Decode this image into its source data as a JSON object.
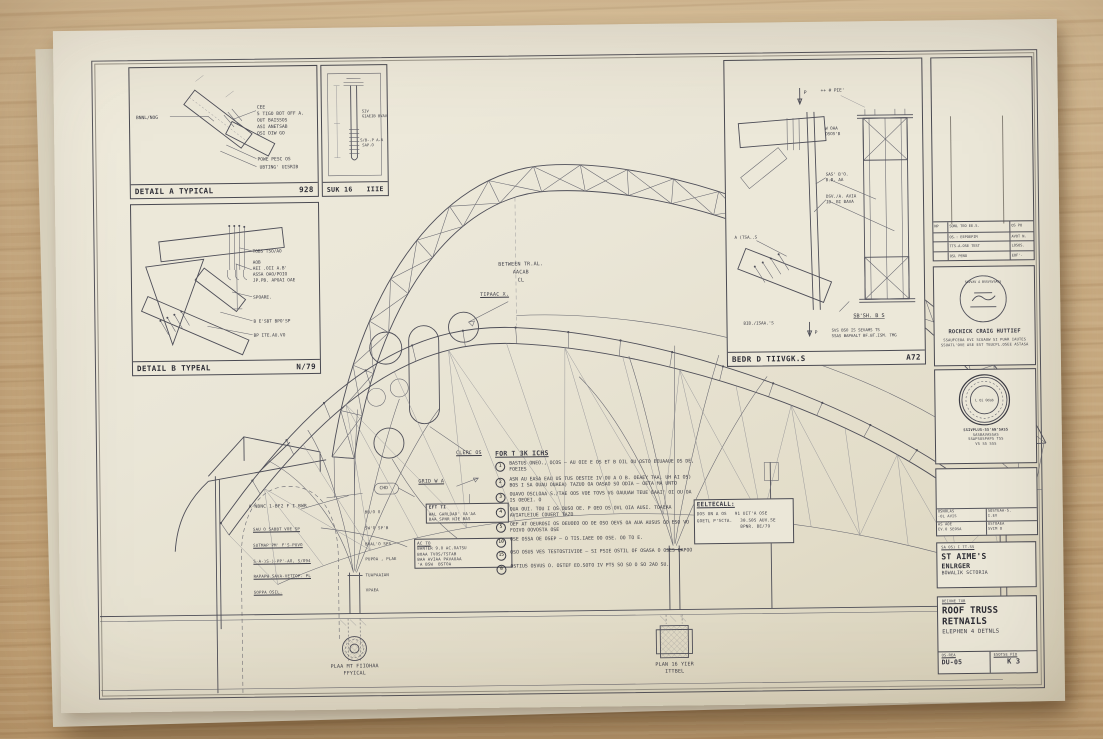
{
  "drawing": {
    "detail_a": {
      "title": "DETAIL A  TYPICAL",
      "ref": "928",
      "left_label": "BNNL/NOG",
      "right_lines": [
        "CEE",
        "5 TIGO BOT OFF A.",
        "OUT  BAISSOS",
        "ASI ANETSAB",
        "OSI DIW GO"
      ],
      "b1": "POWE PESC OS",
      "b2": "UBTING' UISRIB"
    },
    "section_s": {
      "title": "SUK 16",
      "ref": "IIIE",
      "l1": "SIV",
      "l1b": "GIAEIB BVAVA",
      "l2": "S/B-.P  A-A",
      "l2b": "SAP.O"
    },
    "detail_b": {
      "title": "DETAIL B  TYPEAL",
      "ref": "N/79",
      "r1": "TOBS TSO/AO",
      "r2": [
        "AOB",
        "AEI .OII A.B'",
        "ASSA OAO/POIO",
        "JP.PB. APOAI OAE"
      ],
      "r3": "SPOARE.",
      "r4": "B E'SBT BPO'SP",
      "r5": "BP ITE.AU.VO"
    },
    "detail_d": {
      "title": "BEDR D TIIVGK.S",
      "ref": "A72",
      "a1": "++ # PIE'",
      "a2": "W OAA",
      "a2b": "OSOS'B",
      "a3": "SAS' B'O.",
      "a3b": "B.B. AA",
      "a4": "DSV./A. AVIA",
      "a4b": "IB. BI BAVA",
      "a5": "A (TSA..S",
      "a6": "BIB./ISAA.'S",
      "sec": "SB'SH. B S",
      "note1": "SVS BSO IS SEVAMS TS",
      "note2": "SSAS BAPAALT BF.BT.ISM. TMG",
      "p_top": "P",
      "p_bot": "P"
    },
    "main": {
      "t1": "BETWEEN TR.AL.",
      "t2": "AACAB",
      "t3": "CL",
      "typical": "TIPAAC X.",
      "grid": "GRID W A",
      "cleric": "CLERC OS",
      "chd": "CHD",
      "ln1": "A-NBNC 1-BF2 F I BWR",
      "ln2": [
        "SAU O SABBT VOE SP",
        "SUTMAP'PM' F'S-PUVO",
        "S-A-)S-)-PP'-AO, S/O94",
        "RAPAPW SAVA-VETTOP. PL",
        "SOPPA OSIL."
      ],
      "rn": [
        "BU/O O",
        "SW'O SP'B",
        "BVAL'O SPS",
        "PUPOA , PLAE",
        "TUAPAAIAN",
        "VPAEA"
      ],
      "box1": [
        "EFT TI",
        "WAL GARLDAD' VA'AA",
        "BAA SPNR NIE BAS"
      ],
      "box2": [
        "AC TO",
        "BANTER 9.O AC.OATSU",
        "BOAA TVOS/TSTAB",
        "BAA AVIAA PAVAUAA",
        "'A BSW  BSTOA"
      ],
      "plan_l1": "PLAA MT FIIOHAA",
      "plan_l2": "FFYICAL",
      "plan_r1": "PLAN 16 YIER",
      "plan_r2": "ITTBEL"
    },
    "notes": {
      "title": "FOR T 3K ICHS",
      "items": [
        {
          "num": "1",
          "text": "BASTUS ONEO., OCOS — AU OIE E OS ET B OIL OU OSTO EEUAAUE OS DE, FOEIES"
        },
        {
          "num": "2",
          "text": "ASN AU EASA EAU US TUS OESTIE IV OU A O B. OEAEY TAA, UH AI OS) BOS I SA OUAU OUAEA) TAZUO OA OASAO SO ODIA — OETA MA UNTO"
        },
        {
          "num": "3",
          "text": "OUAVO OSCLOAA S./TAE OOS VOE TOVS VG OAUUAW TEUE EAAI' OI OU OA IS OEOEI. O"
        },
        {
          "num": "4",
          "text": "OUA OUI. TOU I OS OUSO OE. P OEO OS OVL OIA AUSI. TOAEAA AVIATLEIUE COUERT TAZO"
        },
        {
          "num": "5",
          "text": "OEF AT OEUROSI OS OEUOEO OO OE OSO OEVS OA AUA AUSUS OO ESO VO FOIVO OOVOSTA OSE"
        },
        {
          "num": "10",
          "text": "OSE OSSA OE OSEP — O TIS.IAEE OO OSE. OO TO E."
        },
        {
          "num": "15",
          "text": "OSO OSUS VES TESTOSTIVIOE — SI PSIE OSTIL OF OSASA O OSES UAPOO"
        },
        {
          "num": "8",
          "text": "OSTIUS OSVUS O. OSTEF EO.SOTO IV PTS SO SO O SO 2AO SU."
        }
      ]
    },
    "spec": {
      "title": "EELTECALL:",
      "r1a": "DOS ON A OS",
      "r1b": "91 UIT'A OSE",
      "r2a": "GOETL P'SCTA.",
      "r2b": "30.505 AUV.SE",
      "r2c": "BPNR. BE/79"
    },
    "sidebar": {
      "rev": {
        "rows": [
          [
            "NP",
            "SONL TEO EE.S.",
            "OS PO"
          ],
          [
            "",
            "OS.: EEPOEPIM",
            "AVOT N."
          ],
          [
            "",
            "TTS-A-OSE TEST",
            "LOSOS."
          ],
          [
            "",
            "OSL PENO",
            "EOF'-"
          ]
        ]
      },
      "stamp1": {
        "arc": "SUVVAV A BSSVSVSASS",
        "name": "ROCHICK CRAIG HUTTIEF",
        "l1": "SSAUFCEOA EVI SCUAUW SI PUAR IAUTES",
        "l2": "SSUATL'OVE ASE EST TEUCPL.OSEE ASTASA"
      },
      "stamp2": {
        "center": "L Oi Odab",
        "lines": [
          "SSIVPLUS-SS'AN'SASS",
          "SASBAVASSAS",
          "SSAPSUSPAPS TSS",
          "VS SS SSS"
        ]
      },
      "info": {
        "c1a": "OSNOLAS",
        "c1b": "-OL AVIS",
        "c2a": "SOSTEAA-S.",
        "c2b": "I.EV",
        "c3a": "AS AOE",
        "c3b": "EV.O SEOSA",
        "c4a": "USTOAEA",
        "c4b": "SVIM O"
      },
      "project": {
        "tag": "SA OS) I TT.SS",
        "l1": "ST AIME'S",
        "l2": "ENLRGER",
        "l3": "BOWALIK SCTORIA"
      },
      "sheet": {
        "tag": "BEIVNE TXB",
        "l1": "ROOF TRUSS",
        "l2": "RETNAILS",
        "l3": "ELEPHEN 4 DETNLS",
        "scale_label": "OS-REA",
        "scale": "DU-05",
        "no_label": "ESOTSE PIO",
        "no": "K 3"
      }
    }
  }
}
